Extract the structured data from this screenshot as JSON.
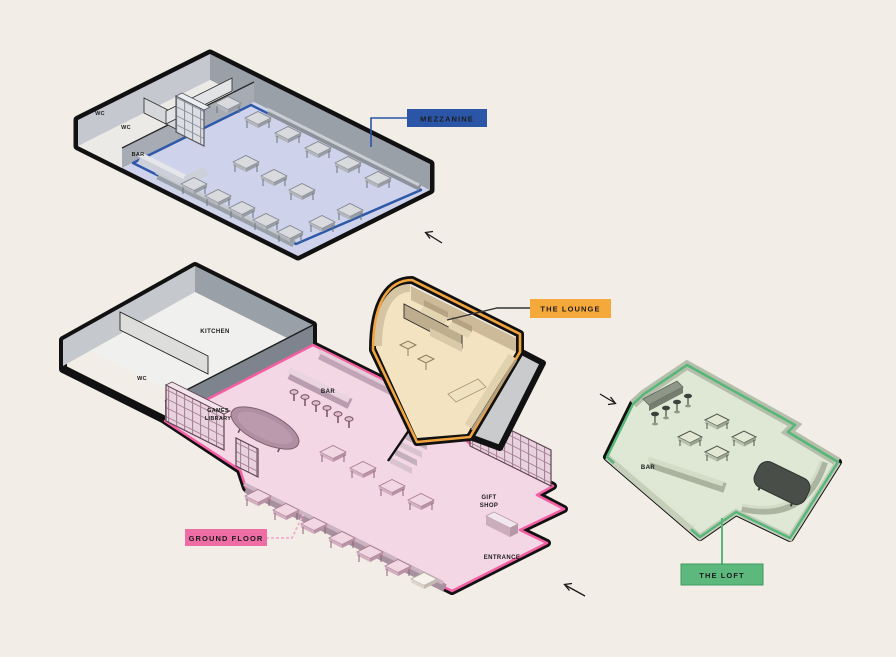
{
  "background": "#f2ede6",
  "badges": {
    "mezzanine": {
      "label": "MEZZANINE",
      "bg": "#2b56a7",
      "text_color": "#9db0da"
    },
    "ground_floor": {
      "label": "GROUND FLOOR",
      "bg": "#ee6da5",
      "text_color": "#161616"
    },
    "the_lounge": {
      "label": "THE LOUNGE",
      "bg": "#f5a93b",
      "text_color": "#161616"
    },
    "the_loft": {
      "label": "THE LOFT",
      "bg": "#5cb87c",
      "text_color": "#161616"
    }
  },
  "room_labels": {
    "wc": "WC",
    "bar": "BAR",
    "kitchen": "KITCHEN",
    "games_library_line1": "GAMES",
    "games_library_line2": "LIBRARY",
    "gift_shop_line1": "GIFT",
    "gift_shop_line2": "SHOP",
    "entrance": "ENTRANCE"
  },
  "accent_colors": {
    "mezzanine_outline": "#2e58a8",
    "ground_outline": "#f45fa3",
    "lounge_outline": "#f2a43e",
    "loft_outline": "#55b778",
    "structure_outline": "#111111",
    "leader_pink": "#f4b3d0"
  },
  "floor_colors": {
    "mezzanine": "#ced3eb",
    "mezzanine_annex": "#eceae6",
    "ground": "#f3d7e4",
    "kitchen": "#f0f0ee",
    "lounge": "#f3e3c1",
    "loft": "#dee8d5"
  },
  "arrows": [
    {
      "name": "mezzanine-entry-arrow",
      "direction": "up-left"
    },
    {
      "name": "ground-entrance-arrow",
      "direction": "up-left"
    },
    {
      "name": "loft-entry-arrow",
      "direction": "down-right"
    }
  ]
}
